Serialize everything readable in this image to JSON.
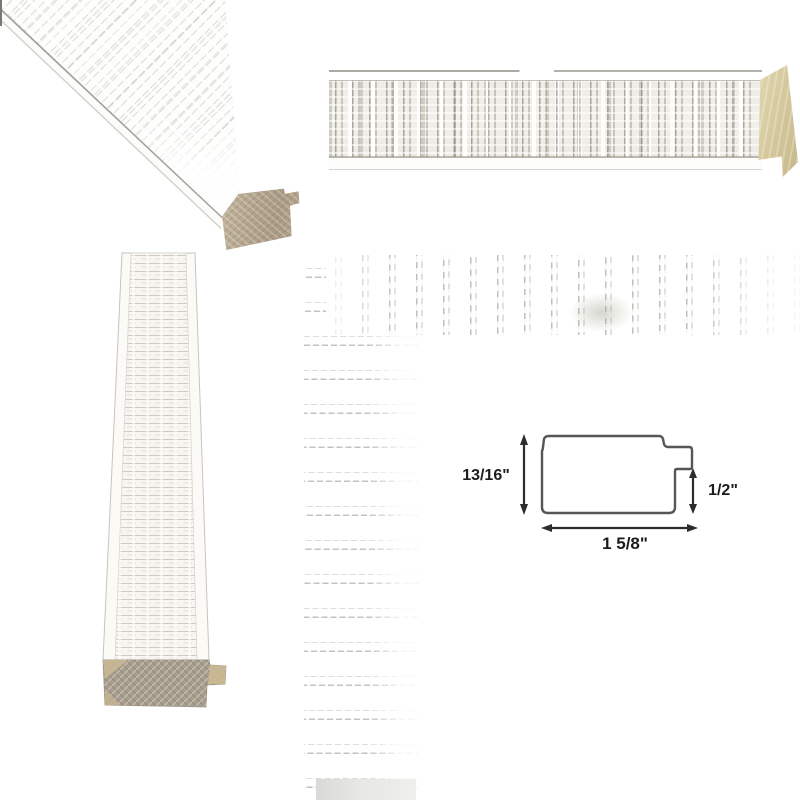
{
  "diagram": {
    "height_label": "13/16\"",
    "lip_height_label": "1/2\"",
    "width_label": "1 5/8\""
  },
  "colors": {
    "background": "#ffffff",
    "moulding_face": "#f8f7f4",
    "texture_stripe": "#a9a49b",
    "raw_wood_light": "#d8cda5",
    "raw_wood_medium": "#b9ab92",
    "raw_wood_dark": "#a29888",
    "diagram_outline": "#565656",
    "diagram_arrow": "#2d2d2d",
    "diagram_text": "#1c1c1c"
  }
}
